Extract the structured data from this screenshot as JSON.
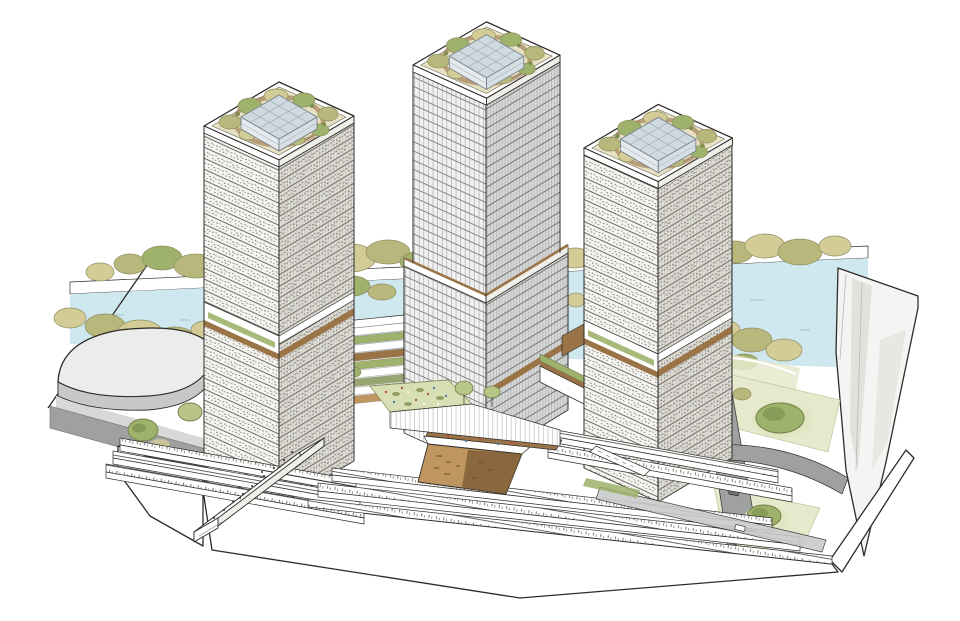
{
  "meta": {
    "title": "Architectural axonometric rendering",
    "subject": "Riverfront mixed-use development with three green-roofed high-rise towers on a terraced podium",
    "style": "hand-drawn line illustration on white background",
    "has_text": false
  },
  "palette": {
    "ink": "#2e2c28",
    "paper": "#ffffff",
    "water": "#cfe7ee",
    "waterDash": "#9ec3cf",
    "foliageKhaki": "#d3cc97",
    "foliageOlive": "#b9b87c",
    "foliageGreen": "#9fb26c",
    "foliageDark": "#7d8f4f",
    "treeDark": "#6e8147",
    "lawn": "#d9dfb4",
    "lawnPale": "#e7e9cd",
    "wood": "#9a7347",
    "woodLight": "#bf965f",
    "woodDark": "#7a5733",
    "road": "#9fa1a1",
    "roadLight": "#c9cbca",
    "sidewalk": "#d8d9d6",
    "parking": "#636666",
    "facade": "#f6f5f1",
    "facadeShade": "#deddd6",
    "facadeCool": "#eef0f1",
    "facadeCoolShade": "#d6d9db",
    "glassTop": "#cfd9e0",
    "glassSide": "#e4e9ed",
    "glassSideDark": "#d6dee4",
    "ribbon": "#f4f4f2",
    "ribbonShade": "#dddddb",
    "accentRed": "#b5543e",
    "accentBlue": "#5b7ea6"
  },
  "scene": {
    "type": "architectural-axonometric-illustration",
    "elements": [
      "tower-left",
      "tower-center",
      "tower-right",
      "rooftop-gardens",
      "glass-roof-pavilions",
      "sky-terrace-bands",
      "river",
      "riverbank-tree-rows",
      "riverfront-step-terraces",
      "podium-terraces",
      "sunken-timber-plaza",
      "podium-roof-garden",
      "pedestrian-ramp-bridge",
      "curved-pavilion-building",
      "street-trees",
      "park-lawns-with-tree-clusters",
      "roads-with-cars",
      "white-site-plinth",
      "elevated-ribbon-structure"
    ]
  }
}
